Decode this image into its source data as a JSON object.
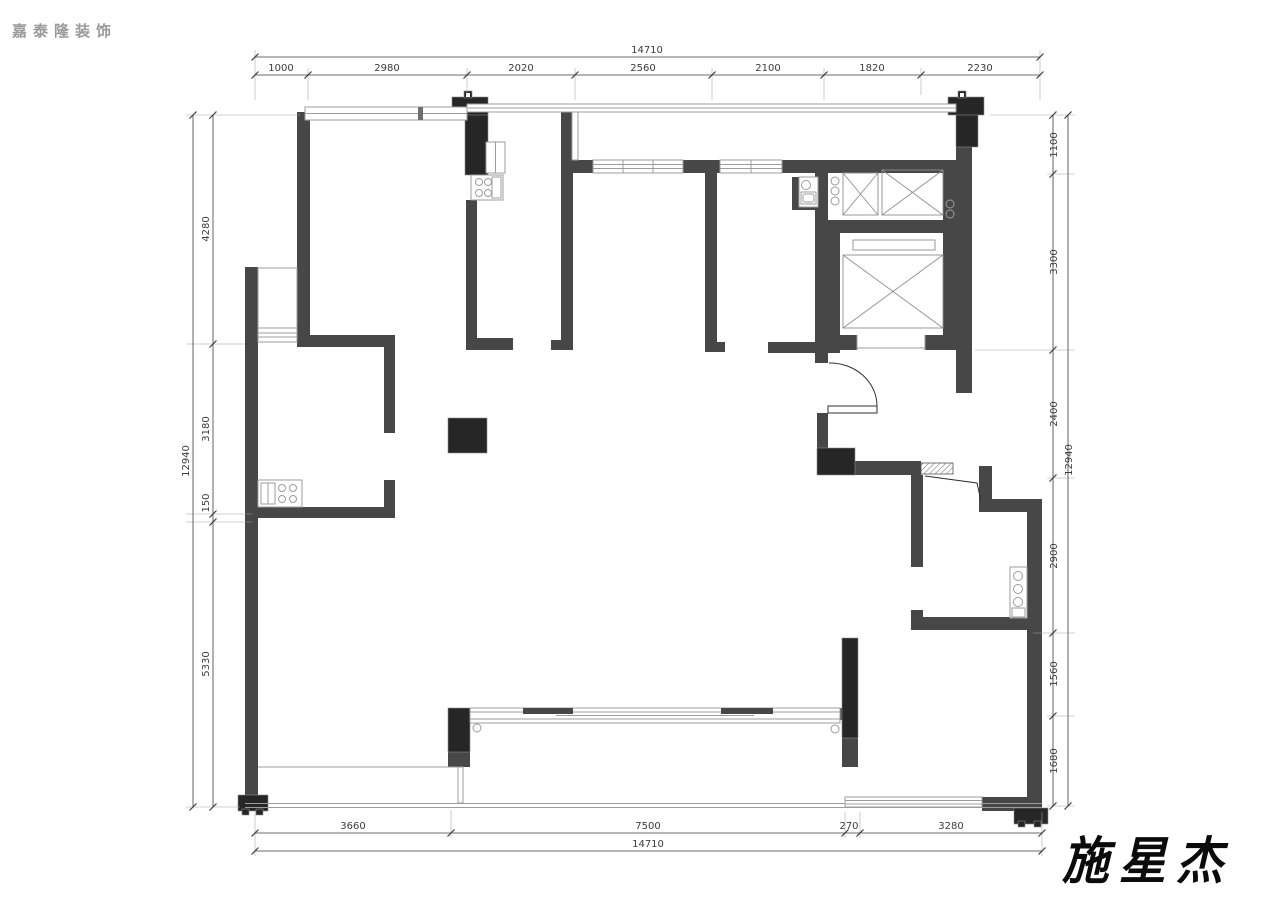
{
  "branding": {
    "logo_text": "嘉泰隆装饰",
    "signature": "施星杰"
  },
  "colors": {
    "wall": "#474747",
    "column": "#262626",
    "thin_line": "#9c9c9c",
    "dimension": "#3c3c3c",
    "logo_gray": "#9a9a9a",
    "background": "#ffffff"
  },
  "dimensions": {
    "top": {
      "total": "14710",
      "segments": [
        "1000",
        "2980",
        "2020",
        "2560",
        "2100",
        "1820",
        "2230"
      ]
    },
    "bottom": {
      "total": "14710",
      "segments": [
        "3660",
        "7500",
        "270",
        "3280"
      ]
    },
    "left": {
      "total": "12940",
      "segments": [
        "4280",
        "3180",
        "150",
        "5330"
      ]
    },
    "right": {
      "total": "12940",
      "segments": [
        "1100",
        "3300",
        "2400",
        "2900",
        "1560",
        "1680"
      ]
    }
  }
}
